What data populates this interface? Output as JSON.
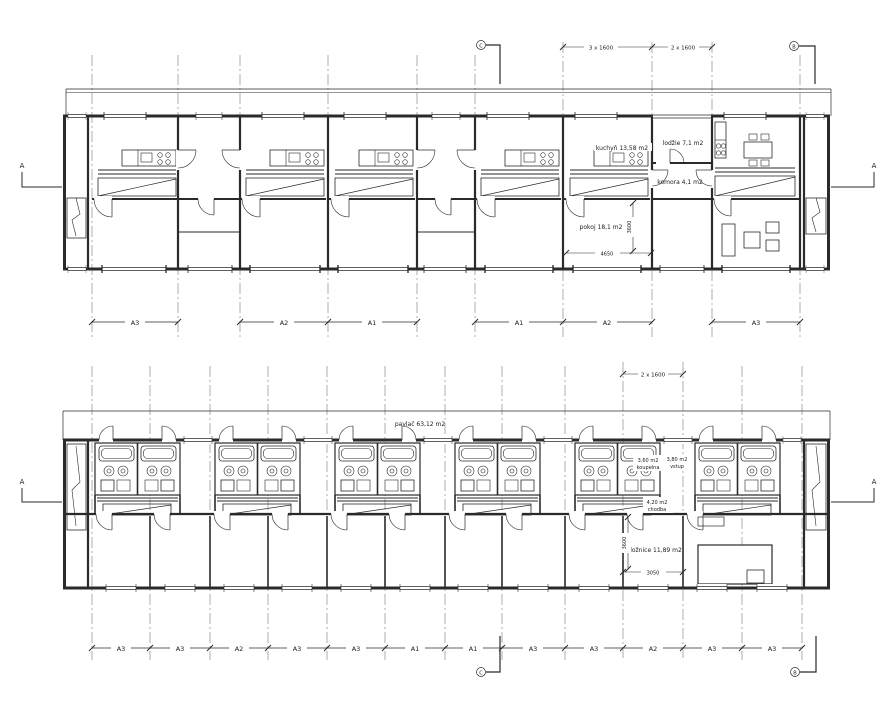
{
  "section_markers": {
    "a": "A",
    "b": "B",
    "c": "C"
  },
  "upper_plan": {
    "dim_3x1600": "3 x 1600",
    "dim_2x1600": "2 x 1600",
    "room_kuchyn": "kuchyň 13,58 m2",
    "room_lodzie": "lodžie 7,1 m2",
    "room_komora": "komora 4,1 m2",
    "room_pokoj": "pokoj 18,1 m2",
    "dim_vertical": "3600",
    "dim_horizontal": "4650",
    "brackets": [
      "A3",
      "A2",
      "A1",
      "A1",
      "A2",
      "A3"
    ]
  },
  "lower_plan": {
    "dim_2x1600": "2 x 1600",
    "room_pavlac": "pavlač 63,12 m2",
    "koupelna_area": "3,60 m2",
    "koupelna_name": "koupelna",
    "vstup_area": "3,80 m2",
    "vstup_name": "vstup",
    "chodba_area": "4,20 m2",
    "chodba_name": "chodba",
    "room_loznice": "ložnice 11,89 m2",
    "dim_vertical": "3600",
    "dim_horizontal": "3050",
    "brackets": [
      "A3",
      "A3",
      "A2",
      "A3",
      "A3",
      "A1",
      "A1",
      "A3",
      "A3",
      "A2",
      "A3",
      "A3"
    ]
  }
}
